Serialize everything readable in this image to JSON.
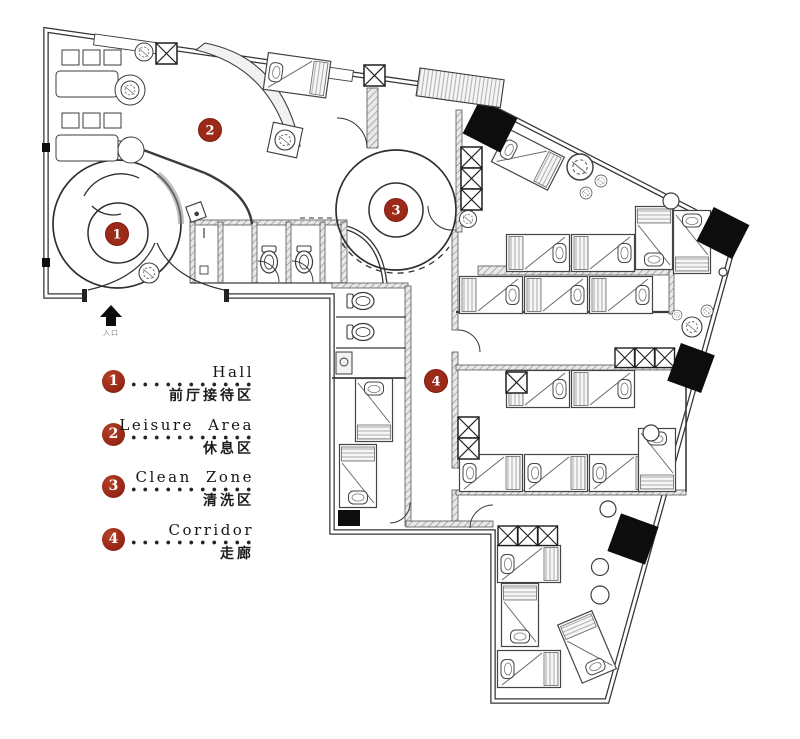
{
  "legend": {
    "items": [
      {
        "num": "1",
        "en": "Hall",
        "zh": "前厅接待区"
      },
      {
        "num": "2",
        "en": "Leisure Area",
        "zh": "休息区"
      },
      {
        "num": "3",
        "en": "Clean Zone",
        "zh": "清洗区"
      },
      {
        "num": "4",
        "en": "Corridor",
        "zh": "走廊"
      }
    ],
    "marker_color": "#9c2a18"
  },
  "plan": {
    "entrance_label": "入口",
    "line_color": "#3a3a3a"
  }
}
